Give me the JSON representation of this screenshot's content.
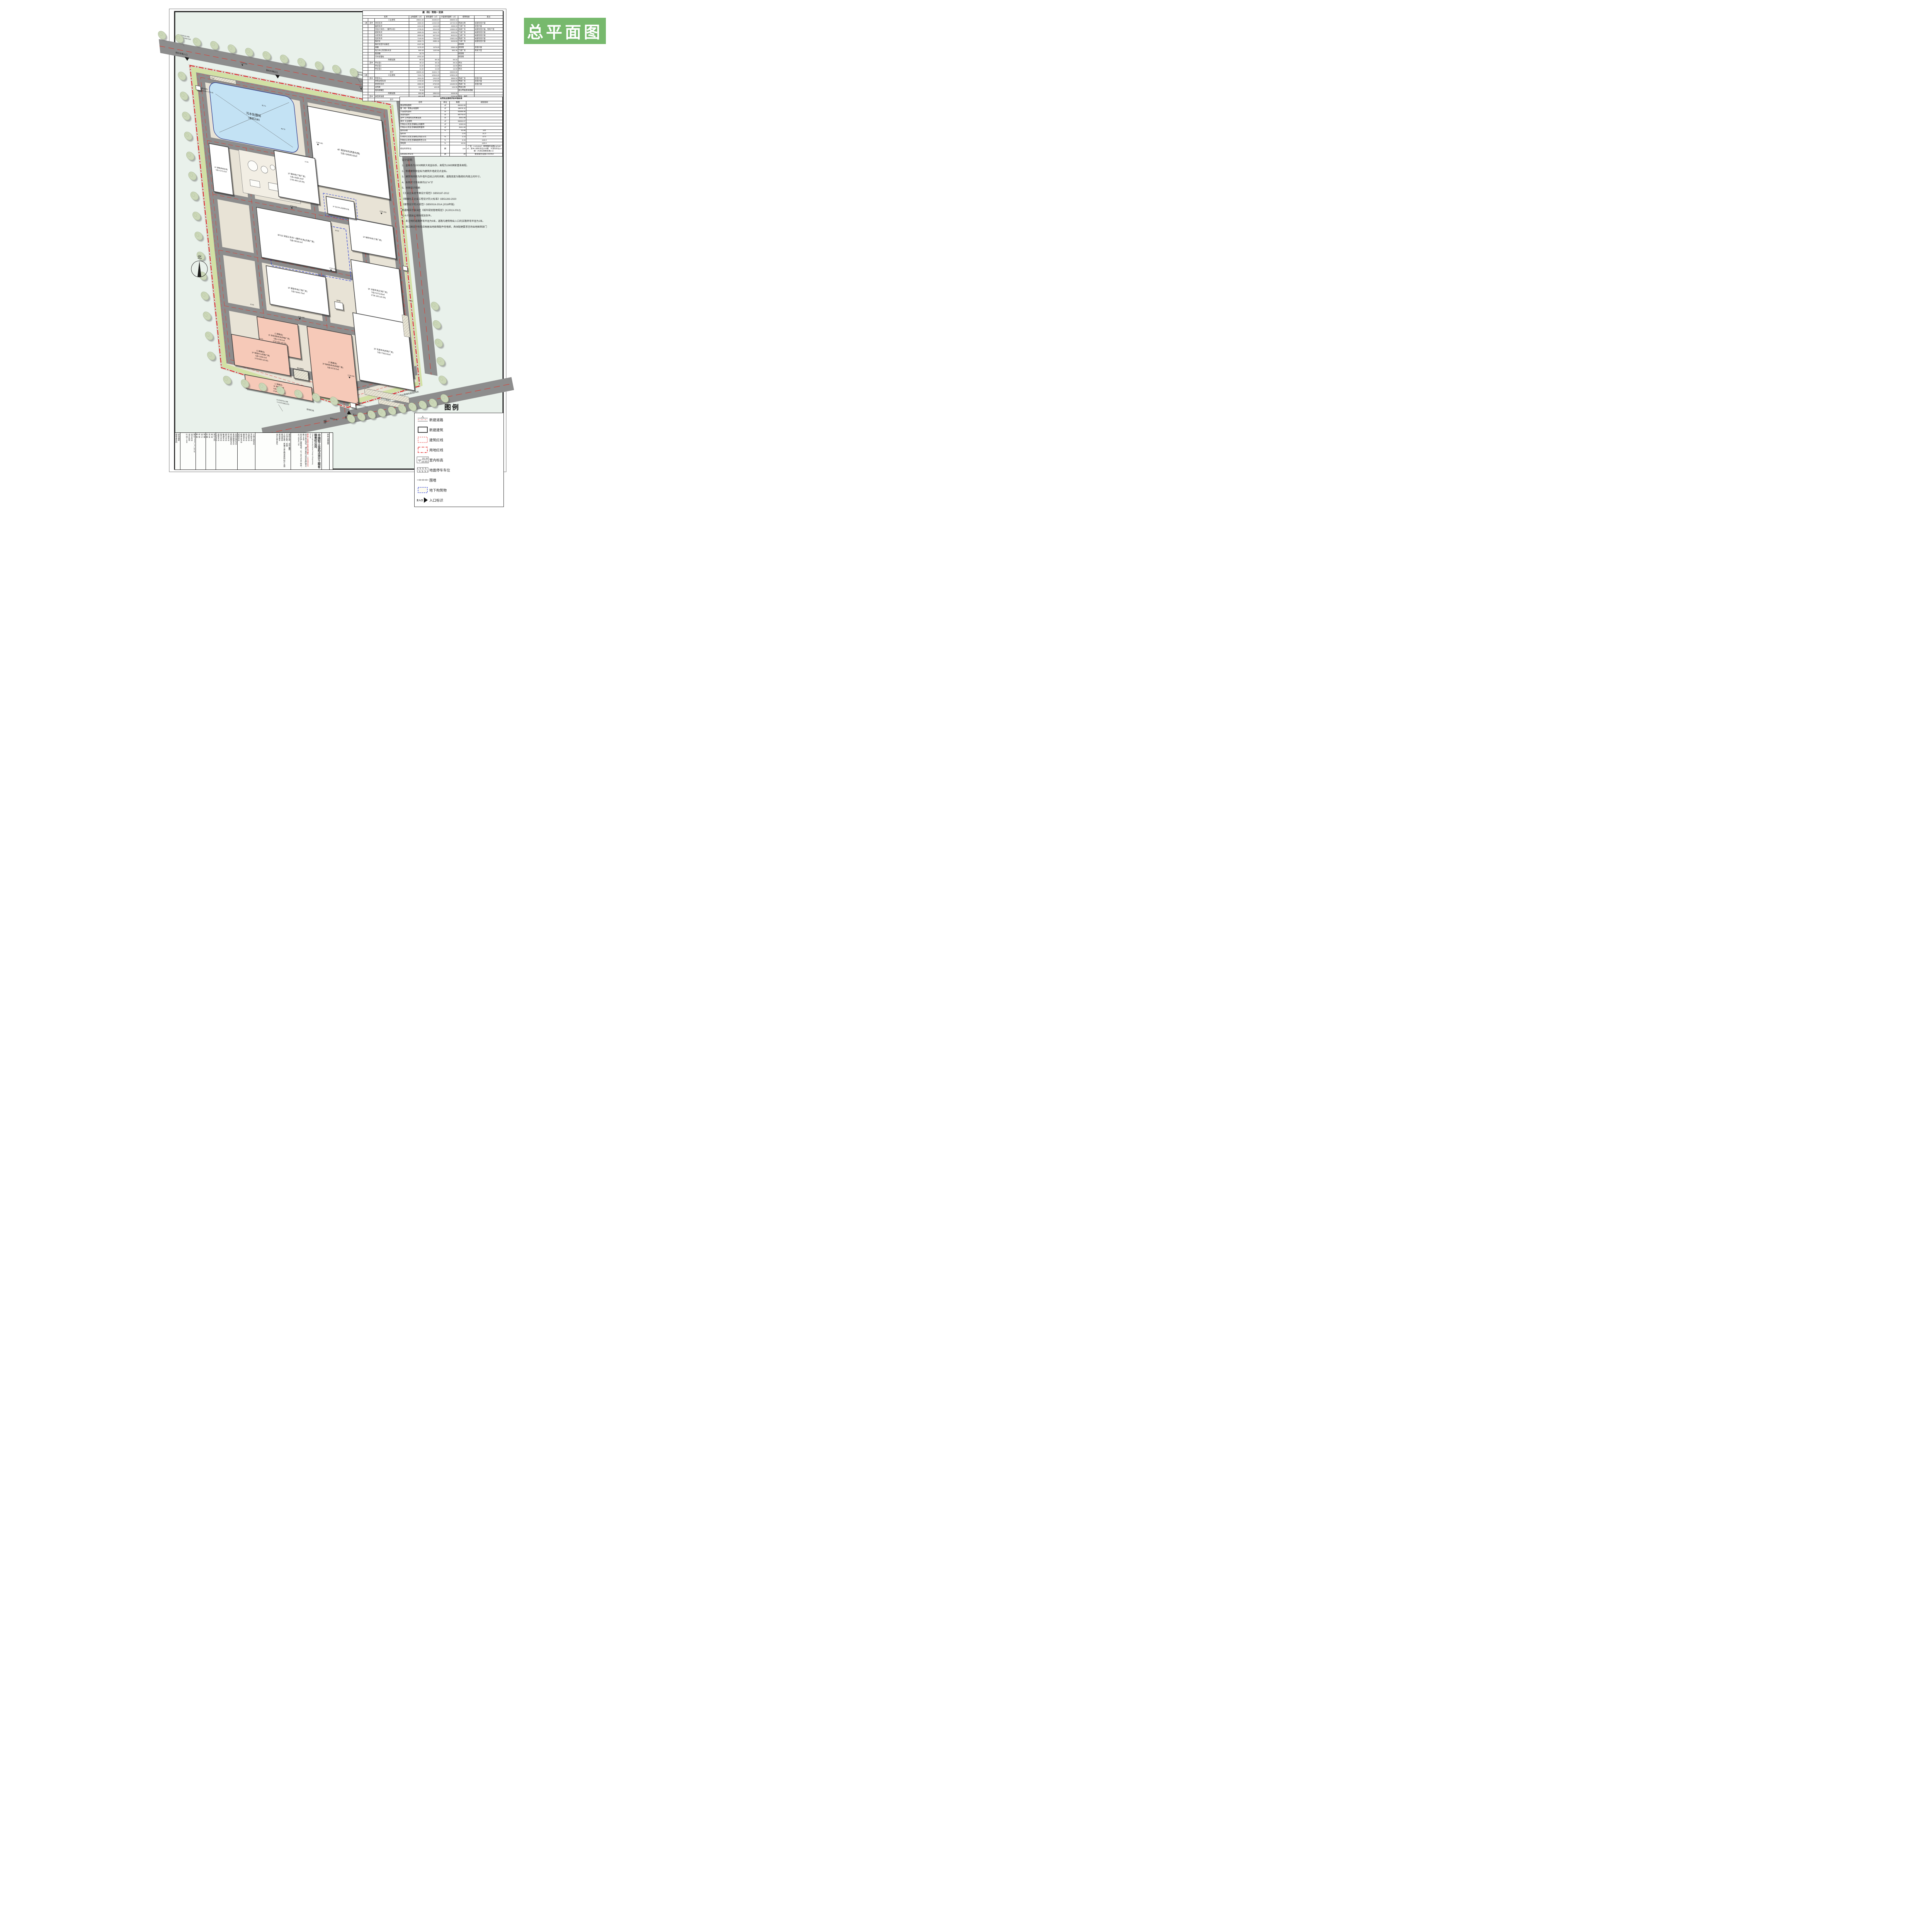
{
  "banner": {
    "title": "总平面图"
  },
  "compass": {
    "label": "北"
  },
  "tables": {
    "buildings": {
      "title": "建（构）筑物一览表",
      "headers": [
        "名称",
        "占地面积（㎡）",
        "建筑面积（㎡）",
        "计容建筑面积（㎡）",
        "使用性质",
        "备注"
      ],
      "rows": [
        [
          "",
          "",
          "工业建筑",
          "30821.32",
          "45335.57",
          "68600.42",
          "",
          ""
        ],
        [
          "一期",
          "其中",
          "清洗车间",
          "4680.00",
          "14040.00",
          "18720.00",
          "丙类仓库",
          "局部双倍计容"
        ],
        [
          "",
          "",
          "破碎车间",
          "1344.00",
          "1344.00",
          "2688.00",
          "丁类厂房",
          "双倍计容"
        ],
        [
          "",
          "",
          "深加工车间一（循环水池）",
          "2736.00",
          "9018.00",
          "13680.00",
          "戊类厂房",
          "局部双倍计容，有地下室"
        ],
        [
          "",
          "",
          "提取车间",
          "2666.25",
          "3444.79",
          "5332.50",
          "丁类厂房",
          "局部双倍计容"
        ],
        [
          "",
          "",
          "分装车间",
          "2805.00",
          "5273.83",
          "8043.91",
          "乙类厂房",
          "局部双倍计容"
        ],
        [
          "",
          "",
          "包装车间",
          "7140.00",
          "7332.63",
          "13821.63",
          "丙类厂房",
          "局部双倍计容"
        ],
        [
          "",
          "",
          "锅炉房",
          "1832.74",
          "2586.16",
          "3403.50",
          "丁类厂房",
          "局部双倍计容"
        ],
        [
          "",
          "",
          "锅炉房室外设备区",
          "2137.46",
          "",
          "",
          "构筑物",
          ""
        ],
        [
          "",
          "",
          "煤棚",
          "1175.20",
          "1175.20",
          "2350.40",
          "构筑物",
          "双倍计容"
        ],
        [
          "",
          "",
          "动力中心及消防水池",
          "560.48",
          "1120.96",
          "560.48",
          "丁类厂房",
          "有地下室"
        ],
        [
          "",
          "",
          "蓖渣罐",
          "40.79",
          "",
          "",
          "构筑物",
          ""
        ],
        [
          "",
          "",
          "污水处理站",
          "3703.40",
          "",
          "",
          "构筑物",
          ""
        ],
        [
          "",
          "",
          "附属设施",
          "69.16",
          "69.16",
          "69.16",
          "",
          ""
        ],
        [
          "",
          "其中",
          "传达室1",
          "39.16",
          "39.16",
          "39.16",
          "传达",
          ""
        ],
        [
          "",
          "",
          "传达室2",
          "15.00",
          "15.00",
          "15.00",
          "传达",
          ""
        ],
        [
          "",
          "",
          "传达室3",
          "15.00",
          "15.00",
          "15.00",
          "传达",
          ""
        ],
        [
          "",
          "",
          "合计",
          "30890.48",
          "45404.73",
          "68669.58",
          "",
          ""
        ],
        [
          "二期",
          "",
          "工业建筑",
          "7234.75",
          "10518.30",
          "20902.30",
          "",
          ""
        ],
        [
          "",
          "其中",
          "育苗中心",
          "1944.00",
          "1944.00",
          "3888.00",
          "丙类厂房",
          "双倍计容"
        ],
        [
          "",
          "",
          "改性淀粉车间",
          "1720.00",
          "1720.00",
          "3440.00",
          "甲类厂房",
          "双倍计容"
        ],
        [
          "",
          "",
          "新材料车间",
          "3360.00",
          "6720.00",
          "13440.00",
          "丙类厂房",
          "双倍计容"
        ],
        [
          "",
          "",
          "试剂库",
          "134.30",
          "134.30",
          "134.30",
          "甲类仓库",
          ""
        ],
        [
          "",
          "",
          "埋地储罐区",
          "76.45",
          "",
          "",
          "部分甲类液体储罐",
          ""
        ],
        [
          "",
          "",
          "附属设施",
          "950.88",
          "2852.64",
          "3328.08",
          "",
          ""
        ],
        [
          "",
          "其中",
          "质检研发楼",
          "950.88",
          "2852.64",
          "3328.08",
          "研发、质检",
          ""
        ],
        [
          "",
          "",
          "合计",
          "8185.63",
          "13370.94",
          "24230.38",
          "",
          ""
        ]
      ]
    },
    "indicators": {
      "title": "总用地主要经济技术指标表",
      "headers": [
        "名称",
        "单位",
        "数量",
        "规划指标"
      ],
      "rows": [
        [
          "建设用地面积",
          "㎡",
          "89492.80",
          ""
        ],
        [
          "建（构）筑物占地面积",
          "㎡",
          "39076.11",
          ""
        ],
        [
          "计容建筑面积",
          "㎡",
          "92899.96",
          ""
        ],
        [
          "总建筑面积",
          "㎡",
          "58775.67",
          ""
        ],
        [
          "其中  公共建筑及附属设施",
          "㎡",
          "2921.80",
          ""
        ],
        [
          "其中  工业建筑",
          "㎡",
          "55853.87",
          ""
        ],
        [
          "行政办公及生活辅助占地面积",
          "㎡",
          "1020.04",
          ""
        ],
        [
          "行政办公及生活辅助建筑面积",
          "㎡",
          "2921.80",
          ""
        ],
        [
          "建筑系数",
          "%",
          "43.66",
          "≥40"
        ],
        [
          "容积率",
          "",
          "1.04",
          "≥1.0"
        ],
        [
          "行政办公及生活辅助占地百分比",
          "%",
          "1.14",
          "≤7.0"
        ],
        [
          "行政办公及生活辅助面积百分比",
          "%",
          "3.15",
          "≤15.0"
        ],
        [
          "绿地率",
          "%",
          "12.51",
          "≤20.0"
        ],
        [
          "机动车停车位",
          "辆",
          "134",
          "厂房：0.2/100㎡；配套服务设施0.8/100㎡；其中小轿车车位104辆，大货车车位12辆（大货车换算系数2.5）"
        ],
        [
          "非机动车停车位",
          "辆",
          "30",
          "配套服务设施1.0/100㎡"
        ]
      ]
    }
  },
  "notes": {
    "title": "设计说明：",
    "lines": [
      "1、坐标系为2000国家大地坐标系，高程为1985国家基准高程。",
      "2、新建建筑物坐标为建筑外墙皮交点坐标。",
      "3、建筑物间距为外墙外边线之间的间距，道路宽度为路缘石内缘之间尺寸。",
      "4、本图尺寸及标高均以“m”计",
      "5、总图设计依据:",
      "《工业企业总平面设计规范》GB50187-2012",
      "《精细化工企业工程设计防火标准》GB51283-2020",
      "《建筑设计防火规范》GB50016-2014 (2018年版)",
      "新疆维吾尔自治区《城市规划管理规定》(XJJ013-2012)",
      "七十六团出让地块规划条件。",
      "6、未注明的道路转弯半径为9米，道路与建筑物出入口的支路转弯半径为2米。",
      "7、施工图设计阶段应根据当地政策配件充电桩，具体配建要求咨询当地图审部门"
    ]
  },
  "legend": {
    "title": "图例",
    "items": [
      "新建道路",
      "新建建筑",
      "建筑红线",
      "用地红线",
      "室内标高",
      "地面停车车位",
      "围墙",
      "地下构筑物",
      "入口标识"
    ],
    "elev_sample_top": "151.00",
    "elev_sample_bottom": "(±0.00)",
    "entrance_word": "主入口"
  },
  "titleblock": {
    "cells": [
      {
        "w": 14,
        "lines": [
          "修改版别",
          "图纸条形码"
        ]
      },
      {
        "w": 40,
        "lines": [
          "图 号  ******—**—## ##",
          "设计专业",
          "设计阶段",
          "比 例  1:500"
        ]
      },
      {
        "w": 26,
        "lines": [
          "制 图",
          "设 计",
          "校 核",
          "审 核",
          "审 定",
          "专业负责人",
          "项目负责人"
        ]
      },
      {
        "w": 26,
        "lines": [
          "岗位人员",
          "姓 名",
          "签 名",
          "日 期"
        ]
      },
      {
        "w": 56,
        "lines": [
          "装饰装修专业",
          "景观种植专业",
          "综合管网专业",
          "环保专业",
          "燃气专业",
          "暖通专业",
          "电气专业",
          "建筑专业",
          "工艺专业",
          "专业会签"
        ]
      },
      {
        "w": 46,
        "lines": [
          "人防工程专业",
          "市政专业",
          "自控专业",
          "热力专业",
          "弱电专业",
          "给排水专业",
          "结构专业",
          "总图专业",
          "签 名"
        ]
      },
      {
        "w": 92,
        "lines": [
          "图纸名称：总平面图",
          "子项名称：总图",
          "工程名称：新疆三垒生物基新材料产业园建设项目",
          "建设单位",
          "设计合作单位"
        ]
      },
      {
        "w": 80,
        "company": true,
        "lines": [
          "中国轻工业武汉设计工程有限责任公司",
          "China Light Industry Wuhan Design & Engineering Co.,Ltd.",
          "甲级工程设计资质证书编号：A142001119",
          "设计单位地址：湖北省武汉市武昌区首义路176号",
          "安全生产监督电话：027-88078089  传真：027-88041709"
        ]
      },
      {
        "w": 20,
        "lines": [
          "特种设备盖章"
        ]
      }
    ]
  },
  "site": {
    "pond_name": "污水处理站",
    "pond_sub": "（埋深≤5米）",
    "pond_dim_a": "81.71",
    "pond_dim_b": "45.73",
    "road_bottom": "茅 松 线",
    "slope_note1": "1:2放坡区域",
    "slope_note2": "放坡起点标高比围墙标高低0.4米",
    "entrance_exit_top": "原料车辆出口",
    "entrance_in_topleft": "原料车辆入口",
    "entrance_main": "主入口",
    "gatehouse1": "传达室1",
    "gatehouse1_elev": "±0.000=1733.3",
    "gatehouse2": "传达室2",
    "gatehouse2_elev": "±0.000=1745.65",
    "nonmotor_label": "非机动车车位",
    "redline_land": "用地红线",
    "redline_bld": "建筑红线",
    "buildings": [
      {
        "fl": "4F",
        "name": "清洗车间(丙类仓库)",
        "s": "S总=14040.00㎡",
        "elev": ""
      },
      {
        "fl": "1F",
        "name": "锅炉房(丁类厂房)",
        "s": "S总=2586.16㎡",
        "elev": "1740.400 (±0.00)"
      },
      {
        "fl": "1F",
        "name": "煤棚(丙类仓库)",
        "s": "S总=1175.20㎡",
        "elev": ""
      },
      {
        "fl": "3F/1D",
        "name": "深加工车间一(循环水池)(戊类厂房)",
        "s": "S总=9018.0㎡",
        "elev": ""
      },
      {
        "fl": "1F",
        "name": "破碎车间(丁类厂房)",
        "s": "",
        "elev": ""
      },
      {
        "fl": "2F",
        "name": "提取车间(丁类厂房)",
        "s": "S总=3444.79㎡",
        "elev": ""
      },
      {
        "fl": "3F",
        "name": "分装车间(乙类厂房)",
        "s": "S总=5273.83㎡",
        "elev": "1736.100 (±0.00)"
      },
      {
        "fl": "2F",
        "name": "包装车间(丙类厂房)",
        "s": "S总=7332.63㎡",
        "elev": ""
      },
      {
        "fl": "2F",
        "name": "动力中心及消防水池",
        "s": "",
        "elev": ""
      },
      {
        "phase": "(二期建设)",
        "fl": "1F",
        "name": "改性淀粉车间(甲类厂房)",
        "s": "S总=1720.0㎡",
        "elev": "1737.000 (±0.00)"
      },
      {
        "phase": "(二期建设)",
        "fl": "2F",
        "name": "新材料车间(丙类厂房)",
        "s": "S总=6720.0㎡",
        "elev": ""
      },
      {
        "phase": "(二期建设)",
        "fl": "1F",
        "name": "育苗中心(丙类厂房)",
        "s": "S总=1944.0㎡",
        "elev": "1734.800 (±0.00)"
      },
      {
        "phase": "(二期建设)",
        "fl": "3F",
        "name": "质检研发楼",
        "s": "S总=2852.64㎡",
        "elev": "1734.000 (±0.00)"
      },
      {
        "fl": "",
        "name": "试剂库",
        "s": "",
        "elev": ""
      },
      {
        "fl": "",
        "name": "埋地储罐区",
        "s": "",
        "elev": ""
      }
    ],
    "spot_elevations": [
      "1744.550",
      "1743.156",
      "1740.400",
      "1738.700",
      "1736.000",
      "1735.300",
      "1734.000",
      "1733.150"
    ],
    "dims": [
      "52.00",
      "84.00",
      "43.00",
      "54.00",
      "15.00",
      "38.00"
    ],
    "parking_labels": [
      "P3",
      "P10",
      "P32"
    ],
    "coords": [
      [
        "X=4764210.405",
        "Y=27471904.519"
      ],
      [
        "X=4764263.213",
        "Y=27472066.443"
      ],
      [
        "X=4763751.208",
        "Y=27471981.573"
      ]
    ]
  }
}
